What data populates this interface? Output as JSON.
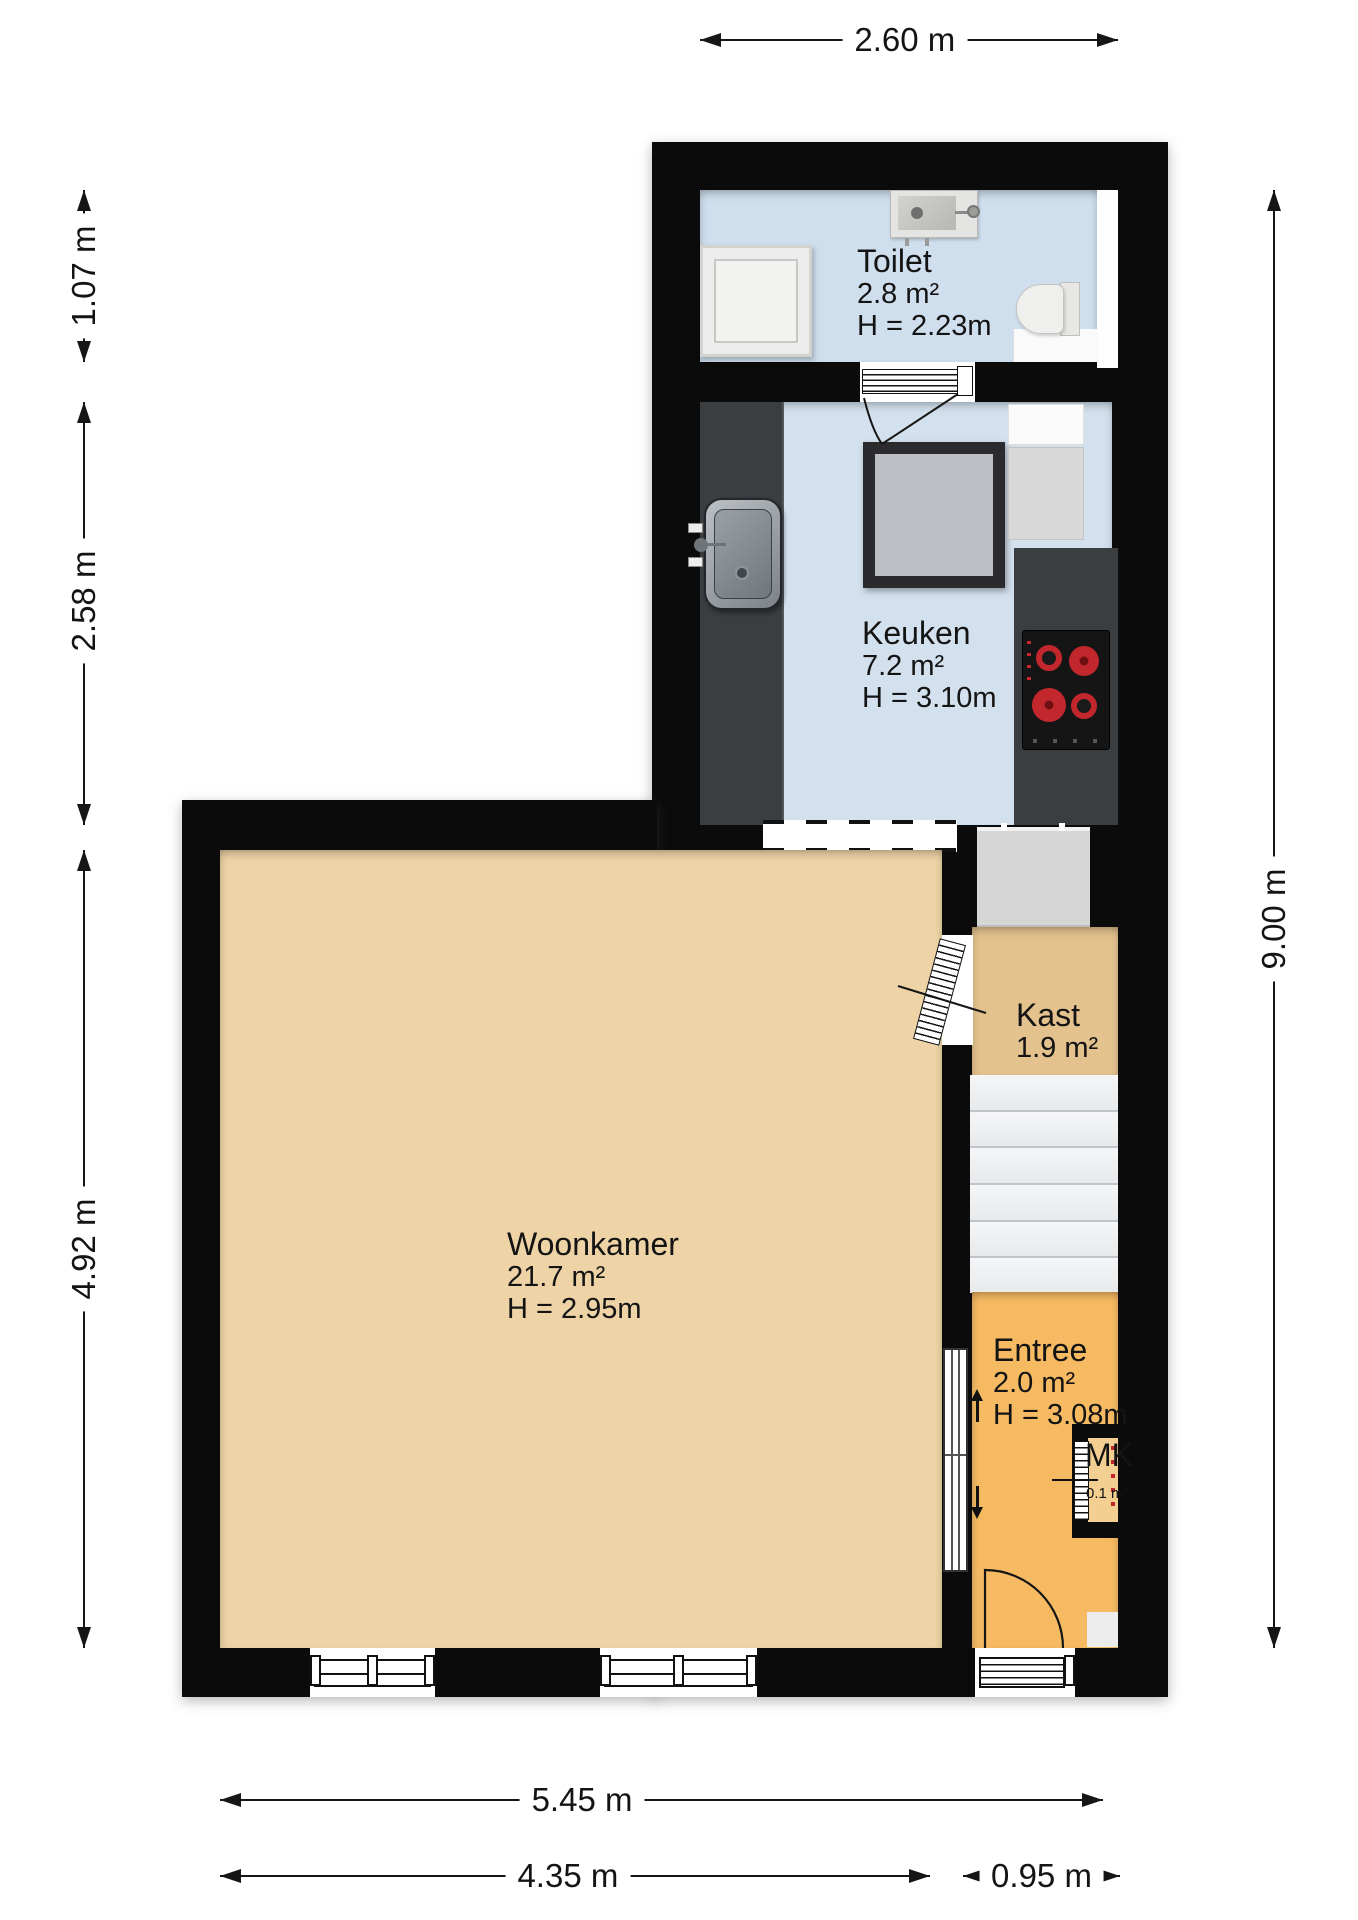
{
  "title": "Floor plan ground floor",
  "rooms": {
    "toilet": {
      "name": "Toilet",
      "area": "2.8 m²",
      "height": "H = 2.23m"
    },
    "keuken": {
      "name": "Keuken",
      "area": "7.2 m²",
      "height": "H = 3.10m"
    },
    "woonkamer": {
      "name": "Woonkamer",
      "area": "21.7 m²",
      "height": "H = 2.95m"
    },
    "kast": {
      "name": "Kast",
      "area": "1.9 m²"
    },
    "entree": {
      "name": "Entree",
      "area": "2.0 m²",
      "height": "H = 3.08m"
    },
    "meterkast": {
      "name": "MK",
      "area": "0.1 m²"
    }
  },
  "dimensions": {
    "top_width": "2.60 m",
    "left_top": "1.07 m",
    "left_middle": "2.58 m",
    "left_bottom": "4.92 m",
    "right_height": "9.00 m",
    "bottom_total": "5.45 m",
    "bottom_left": "4.35 m",
    "bottom_right": "0.95 m"
  },
  "colors": {
    "wall": "#0b0b0b",
    "toilet_floor": "#cfdfee",
    "kitchen_floor": "#d3e1ee",
    "living_floor": "#edd3a5",
    "kast_floor": "#e3c28e",
    "entree_floor": "#f6ba62",
    "mk_floor": "#f3cf92",
    "counter": "#3a3e41",
    "stair": "#eef0f2",
    "burner_red": "#c1272d"
  }
}
